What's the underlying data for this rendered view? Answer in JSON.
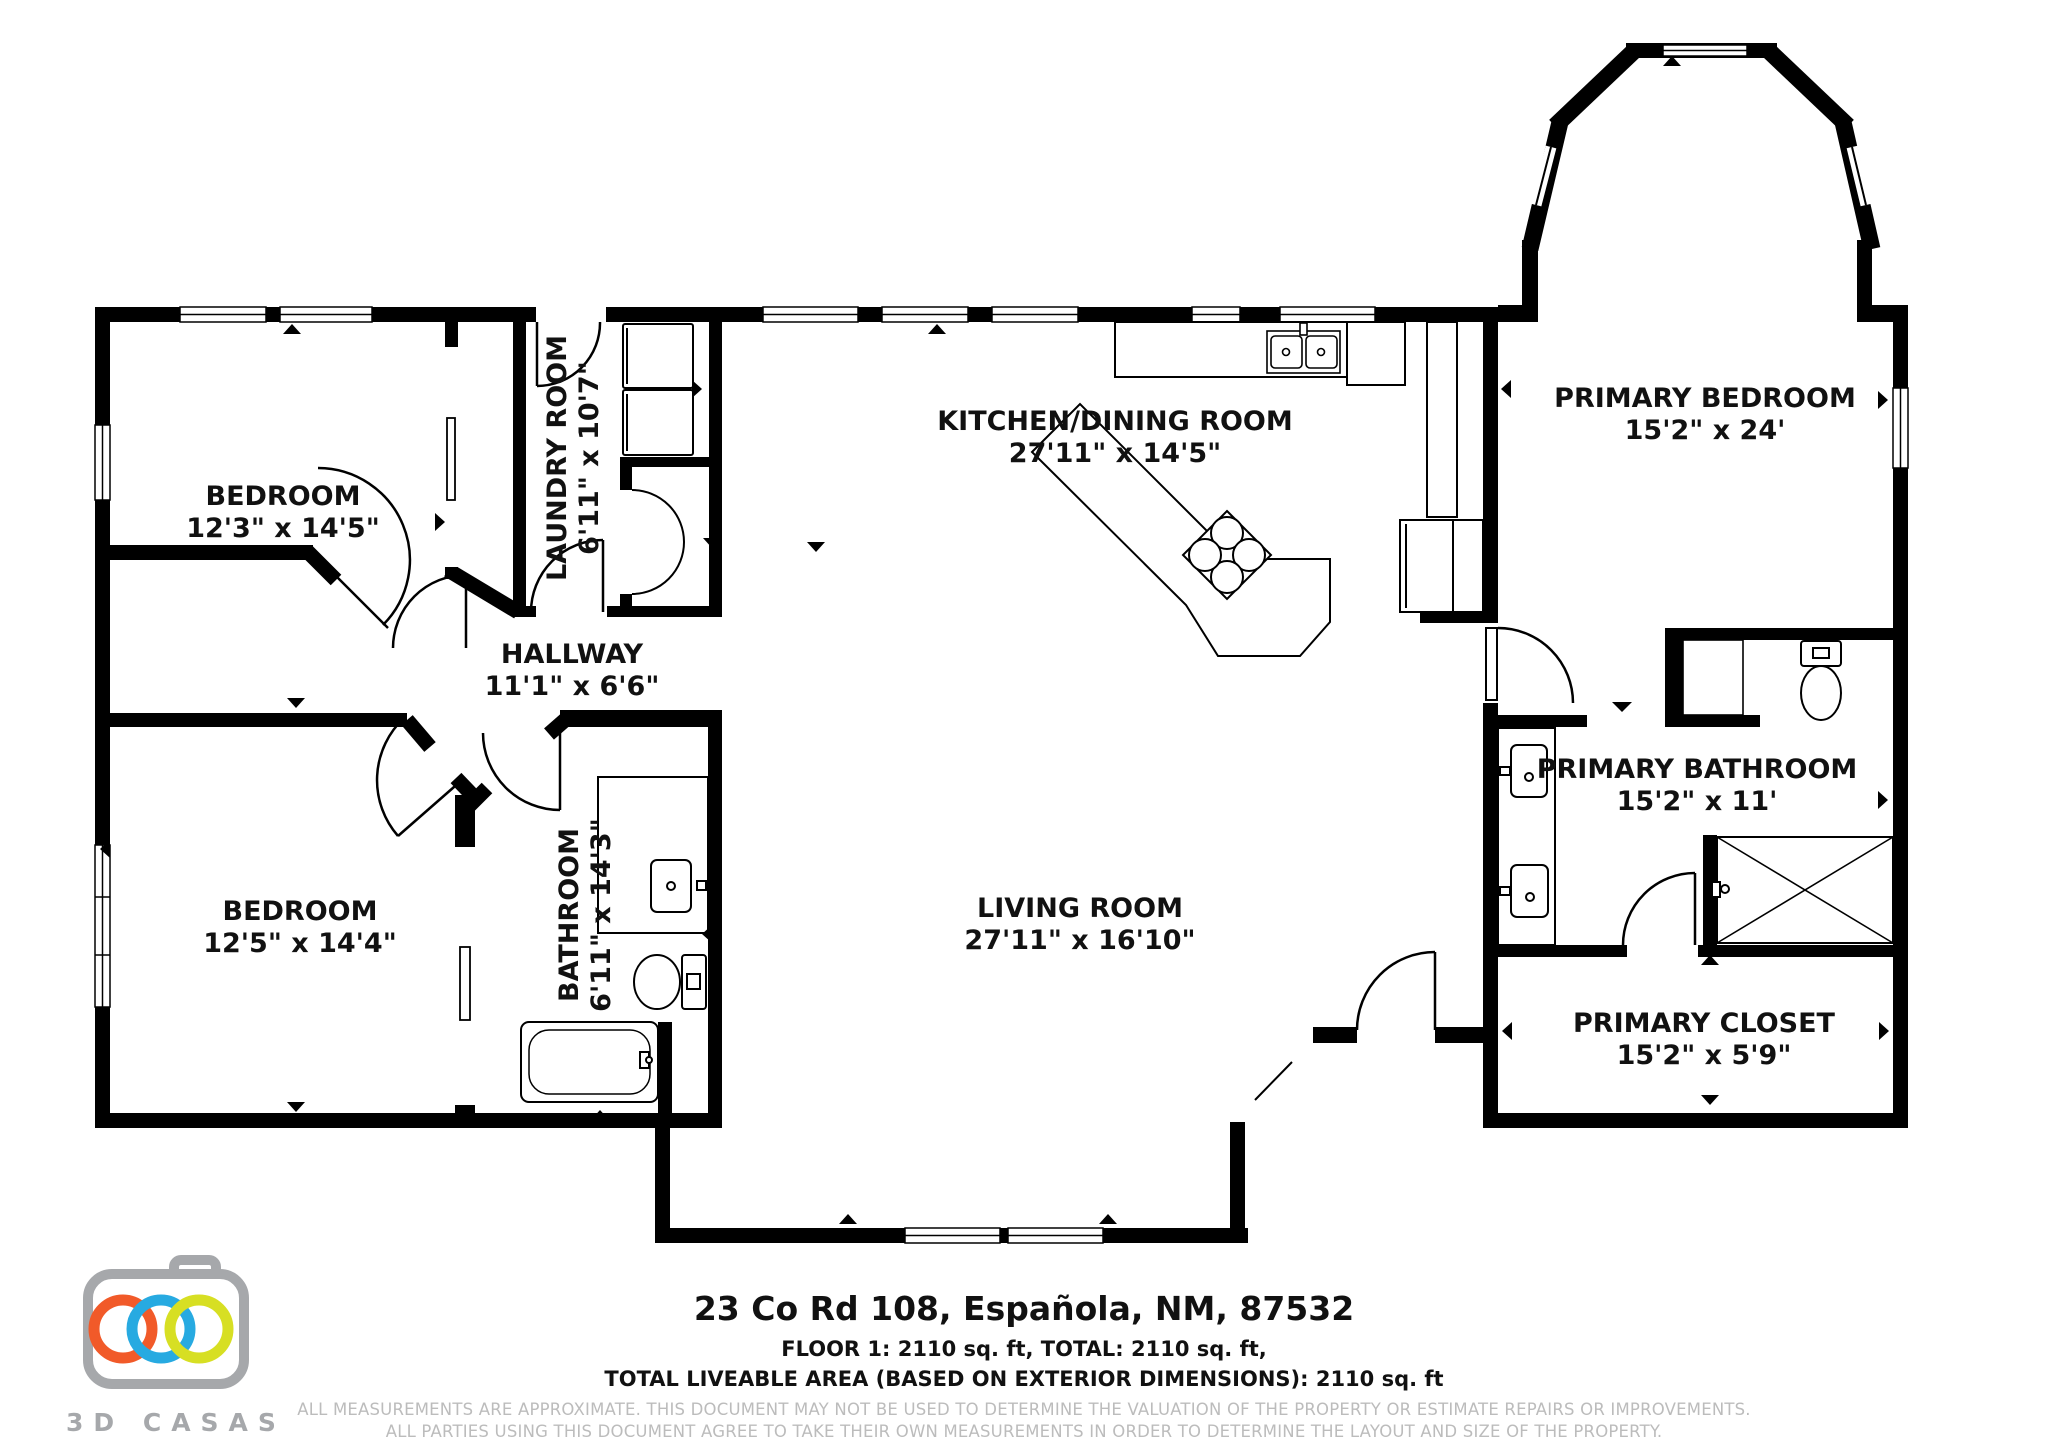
{
  "rooms": [
    {
      "id": "bedroom-1",
      "name": "BEDROOM",
      "dims": "12'3\" x 14'5\""
    },
    {
      "id": "laundry-room",
      "name": "LAUNDRY ROOM",
      "dims": "6'11\" x 10'7\""
    },
    {
      "id": "kitchen-dining-room",
      "name": "KITCHEN/DINING ROOM",
      "dims": "27'11\" x 14'5\""
    },
    {
      "id": "primary-bedroom",
      "name": "PRIMARY BEDROOM",
      "dims": "15'2\" x 24'"
    },
    {
      "id": "hallway",
      "name": "HALLWAY",
      "dims": "11'1\" x 6'6\""
    },
    {
      "id": "bedroom-2",
      "name": "BEDROOM",
      "dims": "12'5\" x 14'4\""
    },
    {
      "id": "bathroom",
      "name": "BATHROOM",
      "dims": "6'11\" x 14'3\""
    },
    {
      "id": "living-room",
      "name": "LIVING ROOM",
      "dims": "27'11\" x 16'10\""
    },
    {
      "id": "primary-bathroom",
      "name": "PRIMARY BATHROOM",
      "dims": "15'2\" x 11'"
    },
    {
      "id": "primary-closet",
      "name": "PRIMARY CLOSET",
      "dims": "15'2\" x 5'9\""
    }
  ],
  "footer": {
    "address": "23 Co Rd 108, Española, NM, 87532",
    "floor_summary": "FLOOR 1: 2110 sq. ft, TOTAL: 2110 sq. ft,",
    "liveable_area": "TOTAL LIVEABLE AREA (BASED ON EXTERIOR DIMENSIONS): 2110 sq. ft",
    "disclaimer_line1": "ALL MEASUREMENTS ARE APPROXIMATE. THIS DOCUMENT MAY NOT BE USED TO DETERMINE THE VALUATION OF THE PROPERTY OR ESTIMATE REPAIRS OR IMPROVEMENTS.",
    "disclaimer_line2": "ALL PARTIES USING THIS DOCUMENT AGREE TO TAKE THEIR OWN MEASUREMENTS IN ORDER TO DETERMINE THE LAYOUT AND SIZE OF THE PROPERTY."
  },
  "logo": {
    "brand": "3D CASAS",
    "colors": {
      "camera_gray": "#A6A8AB",
      "ring_orange": "#F15A29",
      "ring_blue": "#27AAE1",
      "ring_green": "#D7DF23"
    }
  },
  "plan": {
    "wall_color": "#000000",
    "background": "#ffffff",
    "text_color": "#111111"
  }
}
